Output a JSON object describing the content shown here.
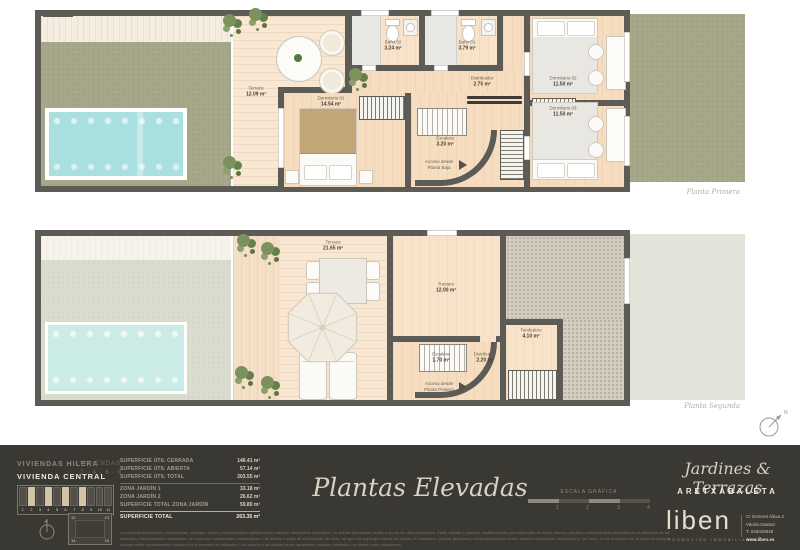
{
  "plans": {
    "compass_label": "N",
    "primera": {
      "caption": "Planta Primera",
      "rooms": {
        "terraza": {
          "name": "Terraza",
          "area": "12.09 m²"
        },
        "dormitorio_01": {
          "name": "Dormitorio 01",
          "area": "14.54 m²"
        },
        "bano_02": {
          "name": "Baño 02",
          "area": "3.24 m²"
        },
        "bano_01": {
          "name": "Baño 01",
          "area": "3.79 m²"
        },
        "distribuidor": {
          "name": "Distribuidor",
          "area": "2.75 m²"
        },
        "escalera": {
          "name": "Escalera",
          "area": "3.20 m²"
        },
        "dormitorio_02": {
          "name": "Dormitorio 02",
          "area": "11.50 m²"
        },
        "dormitorio_03": {
          "name": "Dormitorio 03",
          "area": "11.50 m²"
        },
        "acceso": "Acceso desde Planta Baja"
      }
    },
    "segunda": {
      "caption": "Planta Segunda",
      "rooms": {
        "terraza": {
          "name": "Terraza",
          "area": "21.65 m²"
        },
        "trastero": {
          "name": "Trastero",
          "area": "12.00 m²"
        },
        "tendedero": {
          "name": "Tendedero",
          "area": "4.10 m²"
        },
        "escalera": {
          "name": "Escalera",
          "area": "1.70 m²"
        },
        "distribuidor": {
          "name": "Distribuidor",
          "area": "2.20 m²"
        },
        "acceso": "Acceso desde Planta Primera"
      }
    }
  },
  "footer": {
    "project": {
      "line1": "VIVIENDAS HILERA",
      "line2": "VIVIENDA CENTRAL",
      "units_label": "VIVIENDAS",
      "units_numbers": "2 - 4 - 6 - 8"
    },
    "site_map": {
      "row_numbers": [
        "1",
        "2",
        "3",
        "4",
        "5",
        "6",
        "7",
        "8",
        "9",
        "10",
        "11"
      ],
      "highlighted_units": [
        "2",
        "4",
        "6",
        "8"
      ],
      "block_numbers": [
        "12",
        "13",
        "14",
        "15"
      ]
    },
    "areas": {
      "rows": [
        {
          "label": "SUPERFICIE ÚTIL CERRADA",
          "value": "146.41 m²"
        },
        {
          "label": "SUPERFICIE ÚTIL ABIERTA",
          "value": "57.14 m²"
        },
        {
          "label": "SUPERFICIE ÚTIL TOTAL",
          "value": "203.55 m²"
        },
        {
          "label": "ZONA JARDÍN 1",
          "value": "33.18 m²"
        },
        {
          "label": "ZONA JARDÍN 2",
          "value": "26.62 m²"
        },
        {
          "label": "SUPERFICIE TOTAL ZONA JARDÍN",
          "value": "59.80 m²"
        }
      ],
      "total": {
        "label": "SUPERFICIE TOTAL",
        "value": "263.35 m²"
      }
    },
    "disclaimer": "La presente información, perspectivas, medidas, cotas y documentación gráfica tienen carácter meramente orientativo, no siendo vinculantes desde el punto de vista contractual. Están sujetas a posibles modificaciones por exigencias de índole técnica, jurídica o administrativa derivadas de la obtención de las licencias y autorizaciones necesarias, así como por necesidades constructivas o de diseño a juicio de la Dirección de Obra, sin que ello suponga merma de calidad. El mobiliario, piscina, jardinería y electrodomésticos tienen carácter meramente ornamental y, por tanto, no se entregan con la vivienda excepto cuando estén expresamente incluidos en la memoria de calidades. Los solados y alicatados tienen igualmente carácter orientativo, pudiendo sufrir variaciones.",
    "sheet_title": "Plantas Elevadas",
    "scale": {
      "label": "ESCALA GRÁFICA",
      "ticks": [
        "1",
        "2",
        "3",
        "4"
      ]
    },
    "brand": {
      "script_title": "Jardines & Terrazas",
      "development": "ARETXABALETA",
      "logo": "liben",
      "logo_tagline": "PROMOCIÓN INMOBILIARIA",
      "address_line1": "C/ General Álava 2",
      "address_line2": "Vitoria-Gasteiz",
      "phone": "T. 945029048",
      "web": "www.liben.es"
    }
  },
  "palette": {
    "footer_bg": "#3a3832",
    "wall": "#5d5b55",
    "wood": "#f6ddc0",
    "grass": "#a7a78a",
    "grass_ghost": "#dadcce",
    "pool": "#a9e0df",
    "gravel": "#d5cfc1",
    "accent_beige": "#d2c5a6",
    "text_cream": "#e7dfcd"
  }
}
